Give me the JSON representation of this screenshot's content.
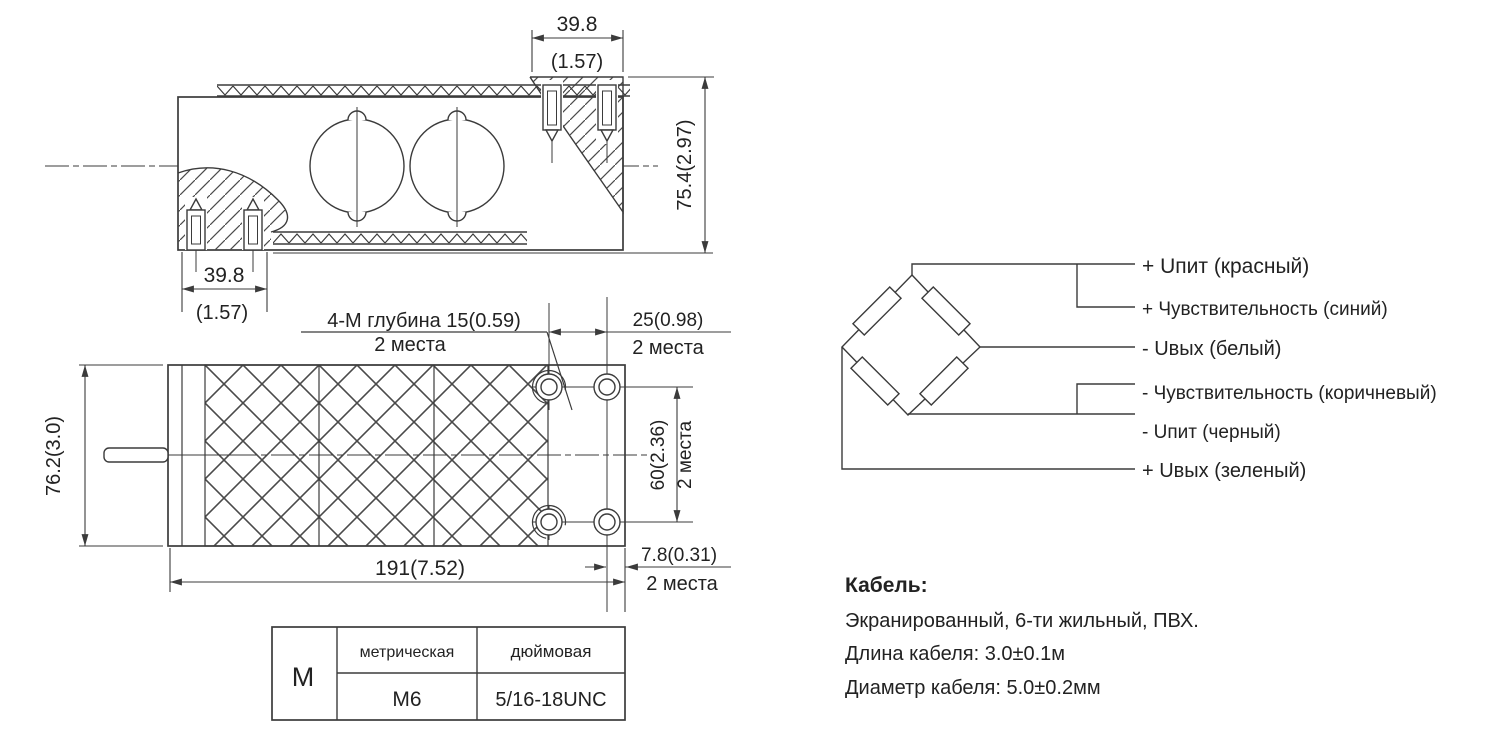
{
  "side_view": {
    "top_dim": "39.8",
    "top_dim_in": "(1.57)",
    "height_dim": "75.4(2.97)",
    "bottom_dim": "39.8",
    "bottom_dim_in": "(1.57)"
  },
  "plan_view": {
    "thread_note": "4-М глубина 15(0.59)",
    "thread_note_qty": "2 места",
    "holes_x_dim": "25(0.98)",
    "holes_x_qty": "2 места",
    "holes_y_dim": "60(2.36)",
    "holes_y_qty": "2 места",
    "edge_dim": "7.8(0.31)",
    "edge_qty": "2 места",
    "length_dim": "191(7.52)",
    "width_dim": "76.2(3.0)"
  },
  "thread_table": {
    "row_label": "М",
    "col_metric": "метрическая",
    "col_inch": "дюймовая",
    "metric_value": "М6",
    "inch_value": "5/16-18UNC"
  },
  "wiring": {
    "labels": [
      "+ Uпит (красный)",
      "+ Чувствительность (синий)",
      "-  Uвых (белый)",
      "-  Чувствительность (коричневый)",
      "-  Uпит (черный)",
      "+ Uвых (зеленый)"
    ]
  },
  "cable": {
    "title": "Кабель:",
    "line1": "Экранированный, 6-ти жильный, ПВХ.",
    "line2": "Длина кабеля: 3.0±0.1м",
    "line3": "Диаметр кабеля: 5.0±0.2мм"
  },
  "colors": {
    "line": "#3b3b3b",
    "text": "#222222",
    "background": "#ffffff"
  }
}
